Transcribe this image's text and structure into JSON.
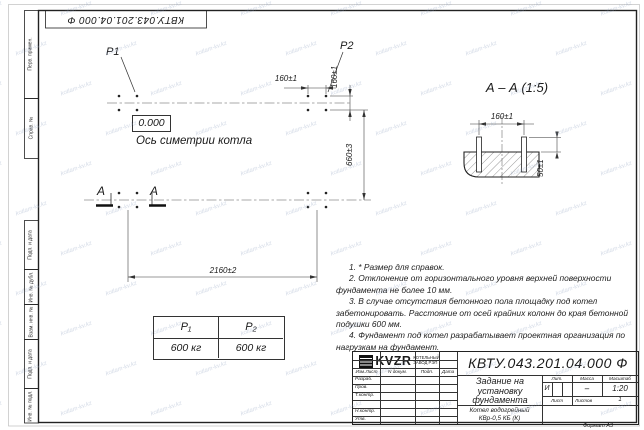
{
  "sheet": {
    "watermark": "kotlam-kv.kz",
    "format": "Формат А3",
    "stamp_doc_number": "КВТУ.043.201.04.000  Ф",
    "margin_labels": {
      "perv": "Перв. примен.",
      "sprav": "Справ. №",
      "podp1": "Подп. и дата",
      "inv_dubl": "Инв. № дубл.",
      "vzam": "Взам. инв. №",
      "podp2": "Подп. и дата",
      "inv_podl": "Инв. № подл."
    }
  },
  "plan": {
    "p1": "P1",
    "p2": "P2",
    "level": "0.000",
    "axis_label": "Ось симетрии котла",
    "dim_160h": "160±1",
    "dim_160v": "160±1",
    "dim_660": "660±3",
    "dim_2160": "2160±2",
    "section_a_left": "А",
    "section_a_right": "А"
  },
  "section": {
    "title": "А – А (1:5)",
    "dim_160": "160±1",
    "dim_50": "50±1"
  },
  "loads": {
    "h1": "P₁",
    "h2": "P₂",
    "v1": "600 кг",
    "v2": "600 кг"
  },
  "notes": [
    "1. * Размер для справок.",
    "2. Отклонение от горизонтального уровня верхней поверхности фундамента не более 10 мм.",
    "3. В случае отсутствия бетонного пола площадку под котел забетонировать. Расстояние от осей крайних колонн до края бетонной подушки 600 мм.",
    "4. Фундамент под котел разрабатывает проектная организация по нагрузкам на фундамент."
  ],
  "title_block": {
    "doc_number": "КВТУ.043.201.04.000  Ф",
    "col_izm": "Изм.Лист",
    "col_doc": "N докум.",
    "col_podp": "Подп.",
    "col_data": "Дата",
    "role_razrab": "Разраб.",
    "role_prov": "Пров.",
    "role_tkontr": "Т.контр.",
    "role_nkontr": "Н.контр.",
    "role_utv": "Утв.",
    "title": "Задание на установку фундамента",
    "lit_label": "Лит.",
    "mass_label": "Масса",
    "scale_label": "Масштаб",
    "lit_value": "И",
    "mass_value": "–",
    "scale_value": "1:20",
    "sheet_label": "Лист",
    "sheets_label": "Листов",
    "sheets_value": "1",
    "product_line1": "Котел водогрейный",
    "product_line2": "КВр-0,5 КБ  (К)",
    "logo_text": "KVZR",
    "company_line1": "КОТЕЛЬНЫЙ",
    "company_line2": "ЗАВОД РЭП"
  }
}
